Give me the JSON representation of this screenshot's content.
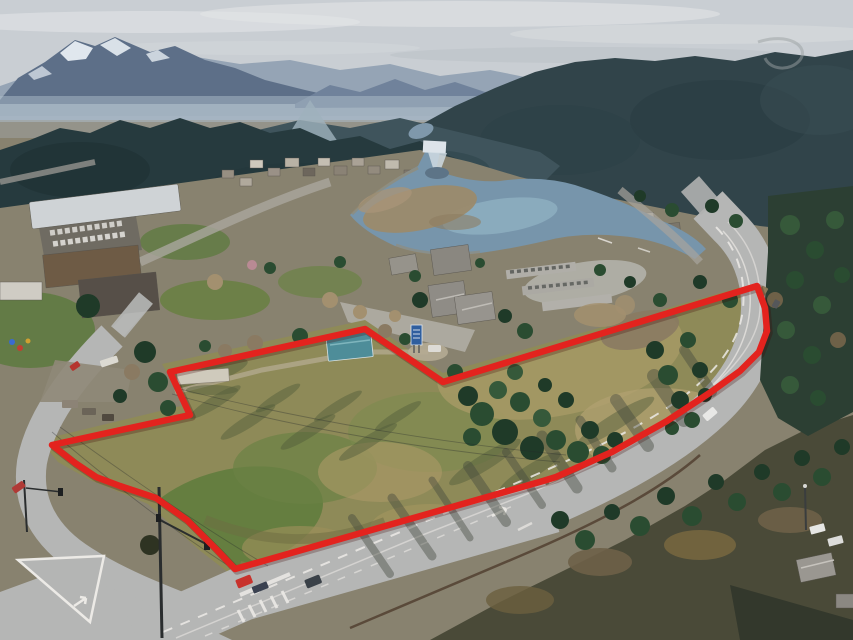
{
  "meta": {
    "type": "aerial-drone-photograph",
    "description": "Aerial view of a lakeside mountain town (Bigfork, Montana style). A large vacant grass parcel in the foreground is outlined with a thick red property-boundary line. A state highway curves along the parcel's south and east edges toward a signalized intersection at lower left. Behind the parcel lie village buildings, a school campus, condominiums, a river bay with a dam, dark conifer hills and snow-capped mountains under a hazy sky.",
    "width_px": 853,
    "height_px": 640
  },
  "scene": {
    "landmarks": [
      "snow-capped mountain range",
      "hazy distant ridge",
      "dark forested hills",
      "dam with white spillway on river",
      "river bay with exposed sand flats",
      "village buildings among trees",
      "school campus with car-filled parking lot",
      "playground equipment",
      "condominium lodge with gabled gray roofs",
      "carport rows with parked cars",
      "row of yellow school buses",
      "vacant grass parcel outlined in red",
      "white office trailer inside parcel",
      "teal-roofed house inside parcel",
      "blue roadside business sign",
      "conifer stand inside parcel",
      "curving two-lane state highway",
      "guardrail along highway",
      "long tree shadows across highway",
      "signalized road intersection",
      "painted traffic island and turn arrows",
      "crosswalk bars",
      "traffic signal poles",
      "power lines crossing parcel",
      "red pickup truck towing trailer",
      "white car on highway",
      "red car on side road",
      "houses and parked trucks at lower right"
    ]
  },
  "colors": {
    "sky": "#c9ced3",
    "cloud": "#dee1e4",
    "mountain": "#5d6f88",
    "ridge_far": "#8fa0b1",
    "snow": "#e7edf3",
    "haze": "#aebdc9",
    "forest_hill": "#263a3e",
    "forest_right": "#31444a",
    "ground": "#88826f",
    "lawn": "#5f7a41",
    "water": "#7795ab",
    "water_light": "#8fb0c2",
    "sandbar": "#9b8a6b",
    "field": "#8e8a58",
    "field_green": "#617c3e",
    "field_dry": "#ab9a68",
    "road": "#b5b6b5",
    "road_dark": "#6f6b62",
    "paint_white": "#eceae6",
    "guardrail": "#5a4a3a",
    "roof_gray": "#94918a",
    "roof_blue": "#4e8d99",
    "sign_blue": "#2f5e9e",
    "trailer_white": "#cfcabc",
    "boundary_red": "#e3231e"
  },
  "boundary": {
    "label": "property-boundary-outline",
    "color": "#e3231e",
    "stroke_width": 6.5,
    "points": "52,445 190,415 170,372 365,329 443,382 757,286 765,308 767,331 759,352 740,371 711,392 667,421 612,452 556,477 543,481 235,569 216,549 187,520 156,498 120,486 96,477 75,463"
  }
}
